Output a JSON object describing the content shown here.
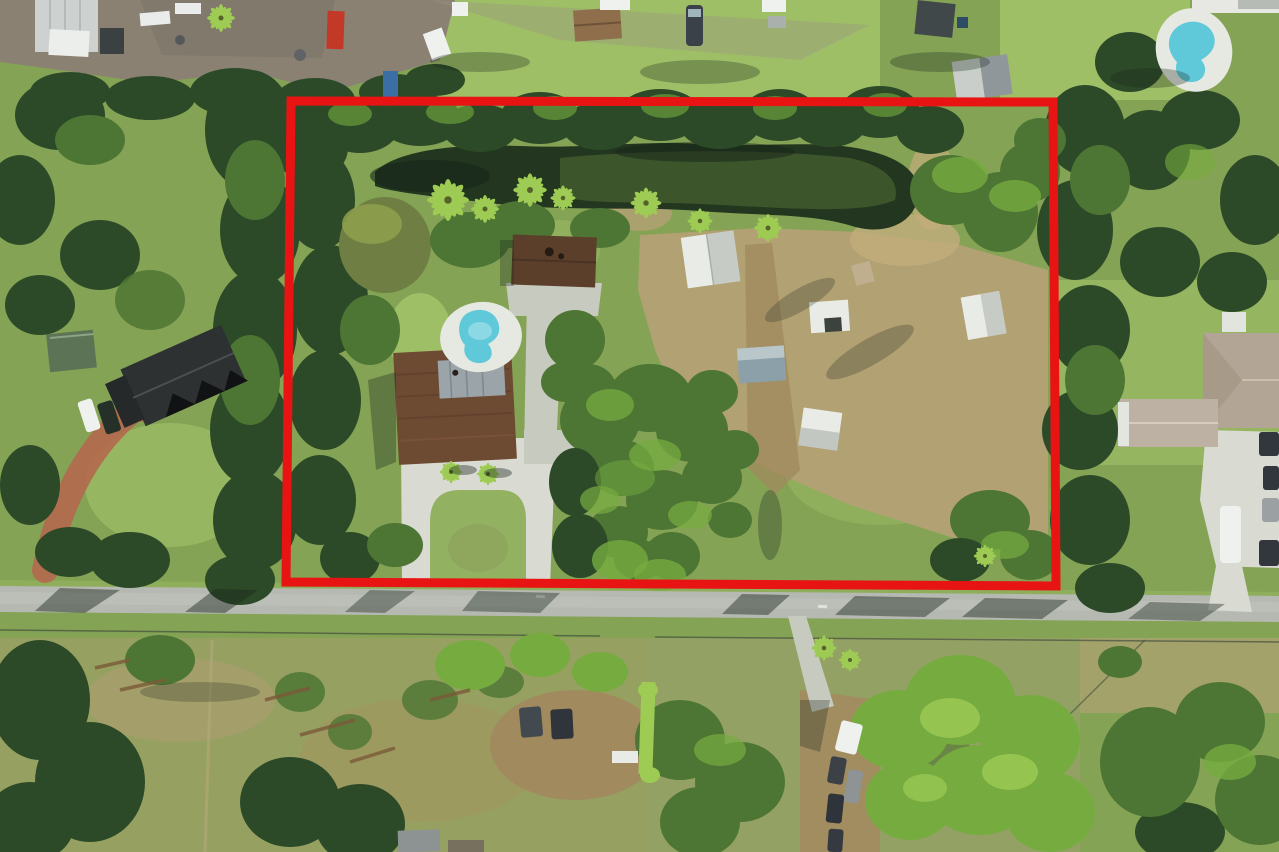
{
  "scene": {
    "type": "aerial-drone-photo",
    "subject": "residential acreage lot outlined with red boundary, canal pond at rear, road at front"
  },
  "boundary": {
    "color": "#e81414",
    "points": "291,101 1053,102 1056,586 286,582",
    "stroke_width": 9
  },
  "colors": {
    "grass_base": "#84a355",
    "grass_bright": "#a8c86e",
    "grass_island": "#93b261",
    "grass_verge": "#8fae5c",
    "scrub_tan": "#b1a173",
    "dirt_brown": "#a08a5e",
    "yard_gravel": "#8a8173",
    "road_gray": "#b5b9b2",
    "concrete": "#d9dbd2",
    "concrete_dim": "#c7cabf",
    "tree_dark": "#2c4a28",
    "tree_mid": "#4d7534",
    "tree_bright": "#76ab40",
    "tree_lime": "#9dcb54",
    "water_dark": "#23361f",
    "water_olive": "#4f6a33",
    "pool_cyan": "#5fc9da",
    "pool_deck": "#e6e9e1",
    "roof_brown": "#6d4a32",
    "roof_brown_dark": "#5c3f2b",
    "roof_metal": "#9ba4a9",
    "roof_white": "#e9ebe6",
    "roof_gray": "#8f979a",
    "roof_dark": "#2d3132",
    "roof_tan": "#b3a595",
    "paver_red": "#b4694e",
    "shadow": "#1c291d",
    "car_dark": "#32373d",
    "car_white": "#eff1ee",
    "container_red": "#c23a27",
    "container_blue": "#3c6ea6"
  }
}
